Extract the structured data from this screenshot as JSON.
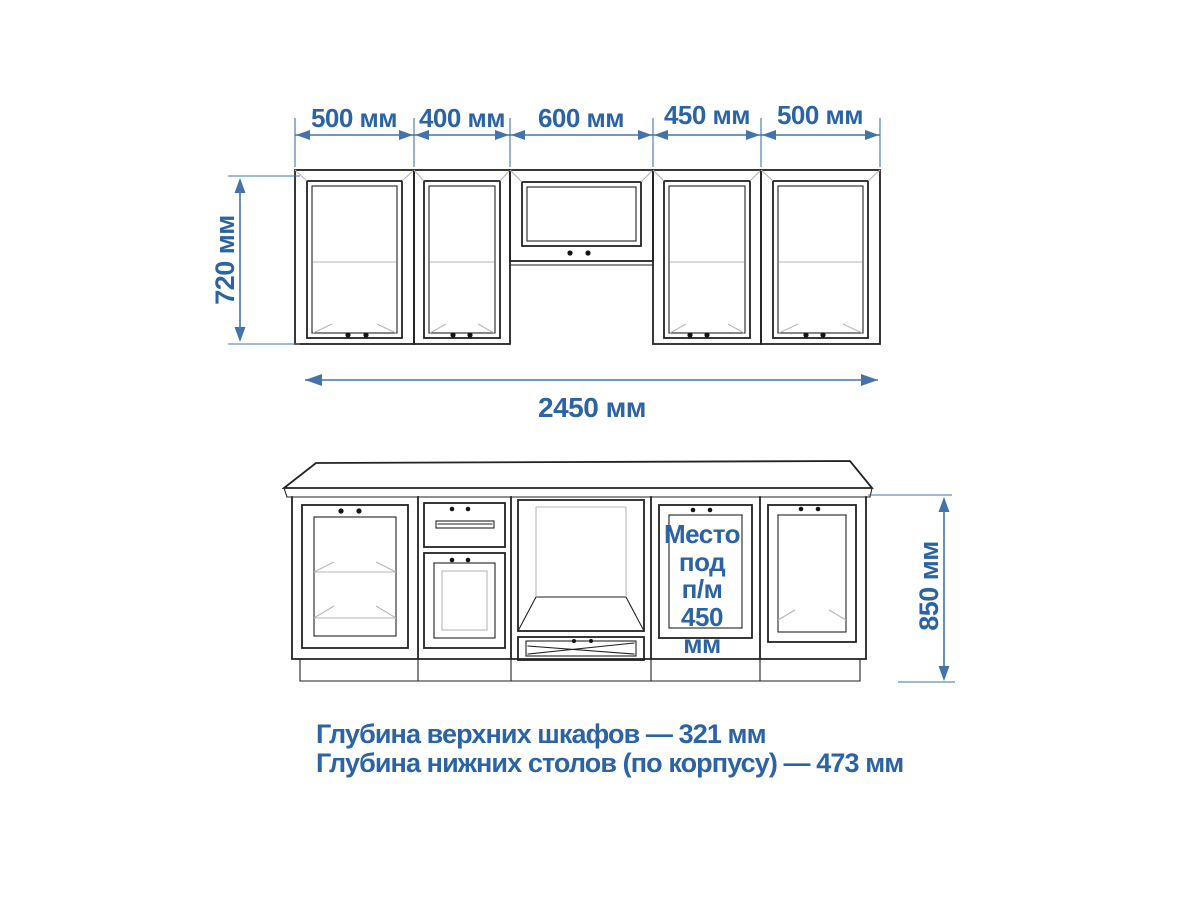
{
  "drawing": {
    "upper_dims": [
      "500 мм",
      "400 мм",
      "600 мм",
      "450 мм",
      "500 мм"
    ],
    "upper_height": "720 мм",
    "total_width": "2450 мм",
    "lower_height": "850 мм",
    "dishwasher_note_lines": [
      "Место",
      "под",
      "п/м",
      "450",
      "мм"
    ],
    "depth_notes": [
      "Глубина верхних шкафов — 321 мм",
      "Глубина нижних столов (по корпусу) — 473 мм"
    ]
  },
  "colors": {
    "text_blue": "#2b63a4",
    "dim_blue": "#4273aa",
    "line_dark": "#222222",
    "line_faint": "#b7b7b7",
    "background": "#ffffff"
  }
}
